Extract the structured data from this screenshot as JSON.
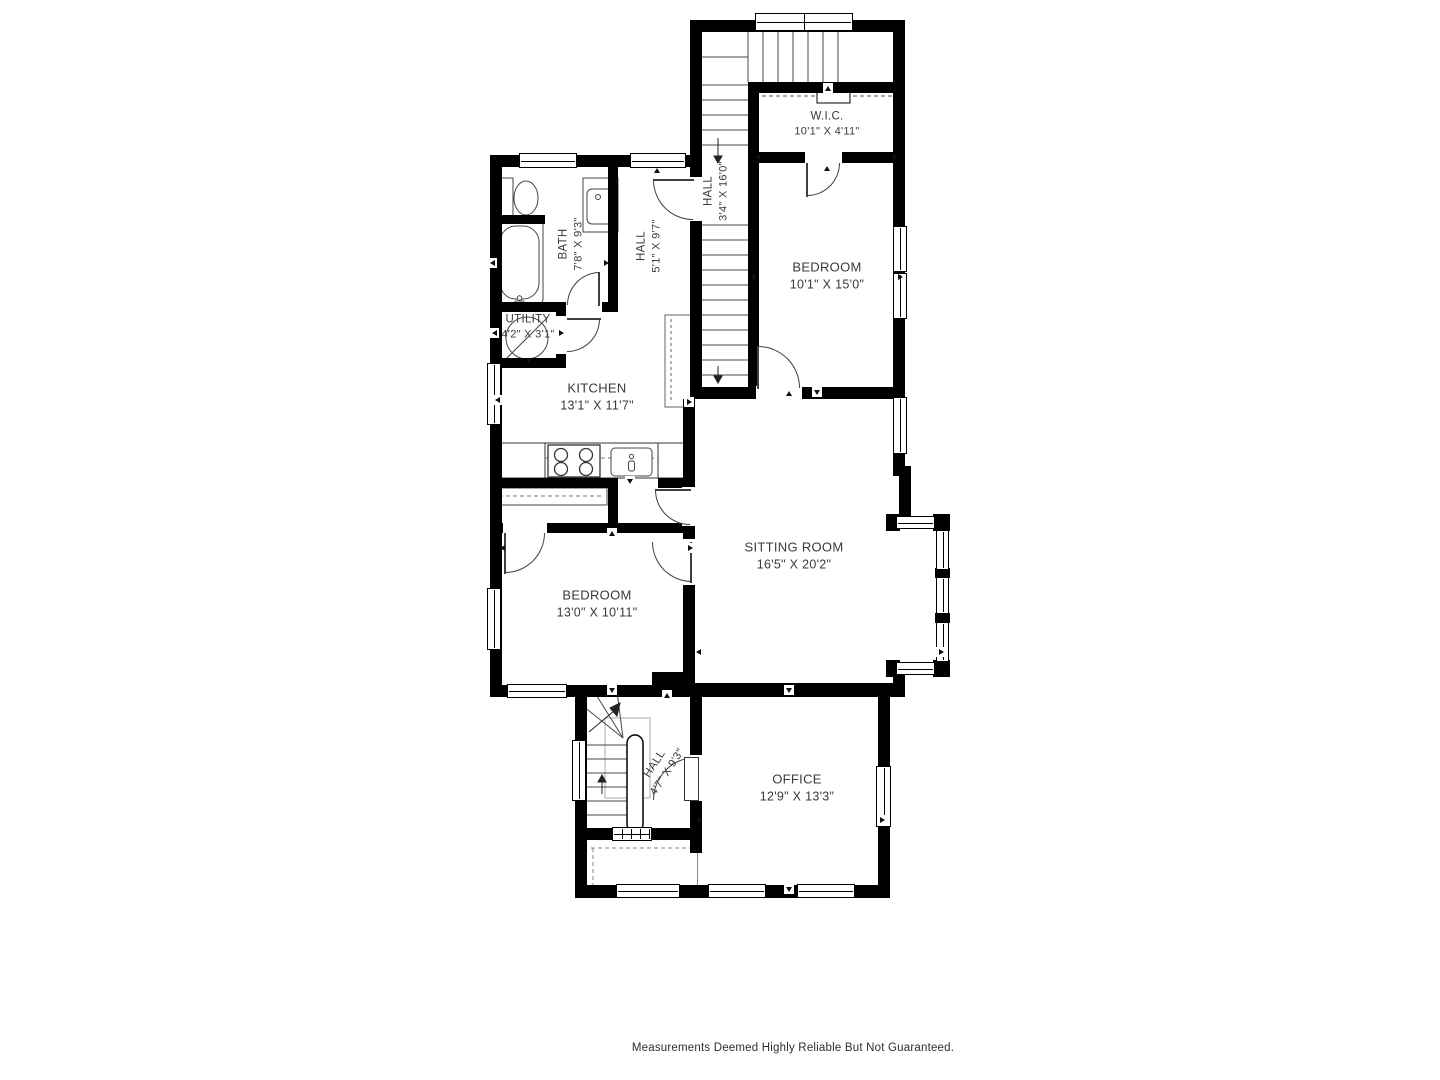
{
  "plan": {
    "rooms": [
      {
        "id": "wic",
        "name": "W.I.C.",
        "dims": "10'1\" X 4'11\""
      },
      {
        "id": "hall-upper",
        "name": "HALL",
        "dims": "3'4\" X 16'0\""
      },
      {
        "id": "bath",
        "name": "BATH",
        "dims": "7'8\" X 9'3\""
      },
      {
        "id": "hall-mid",
        "name": "HALL",
        "dims": "5'1\" X 9'7\""
      },
      {
        "id": "bedroom-upper",
        "name": "BEDROOM",
        "dims": "10'1\" X 15'0\""
      },
      {
        "id": "utility",
        "name": "UTILITY",
        "dims": "4'2\" X 3'1\""
      },
      {
        "id": "kitchen",
        "name": "KITCHEN",
        "dims": "13'1\" X 11'7\""
      },
      {
        "id": "sitting-room",
        "name": "SITTING ROOM",
        "dims": "16'5\" X 20'2\""
      },
      {
        "id": "bedroom-lower",
        "name": "BEDROOM",
        "dims": "13'0\" X 10'11\""
      },
      {
        "id": "hall-lower",
        "name": "HALL",
        "dims": "4'7\" X 9'3\""
      },
      {
        "id": "office",
        "name": "OFFICE",
        "dims": "12'9\" X 13'3\""
      }
    ],
    "fixtures": [
      "toilet",
      "bathtub",
      "vanity-sink",
      "stove",
      "kitchen-sink",
      "kitchen-counter",
      "pantry-cabinet",
      "water-heater",
      "closet-rod",
      "staircase-upper",
      "staircase-main",
      "staircase-lower",
      "handrail",
      "porch-outline"
    ],
    "colors": {
      "wall": "#000000",
      "label": "#3a3a3a",
      "line": "#454545"
    },
    "disclaimer": "Measurements Deemed Highly Reliable But Not Guaranteed."
  }
}
